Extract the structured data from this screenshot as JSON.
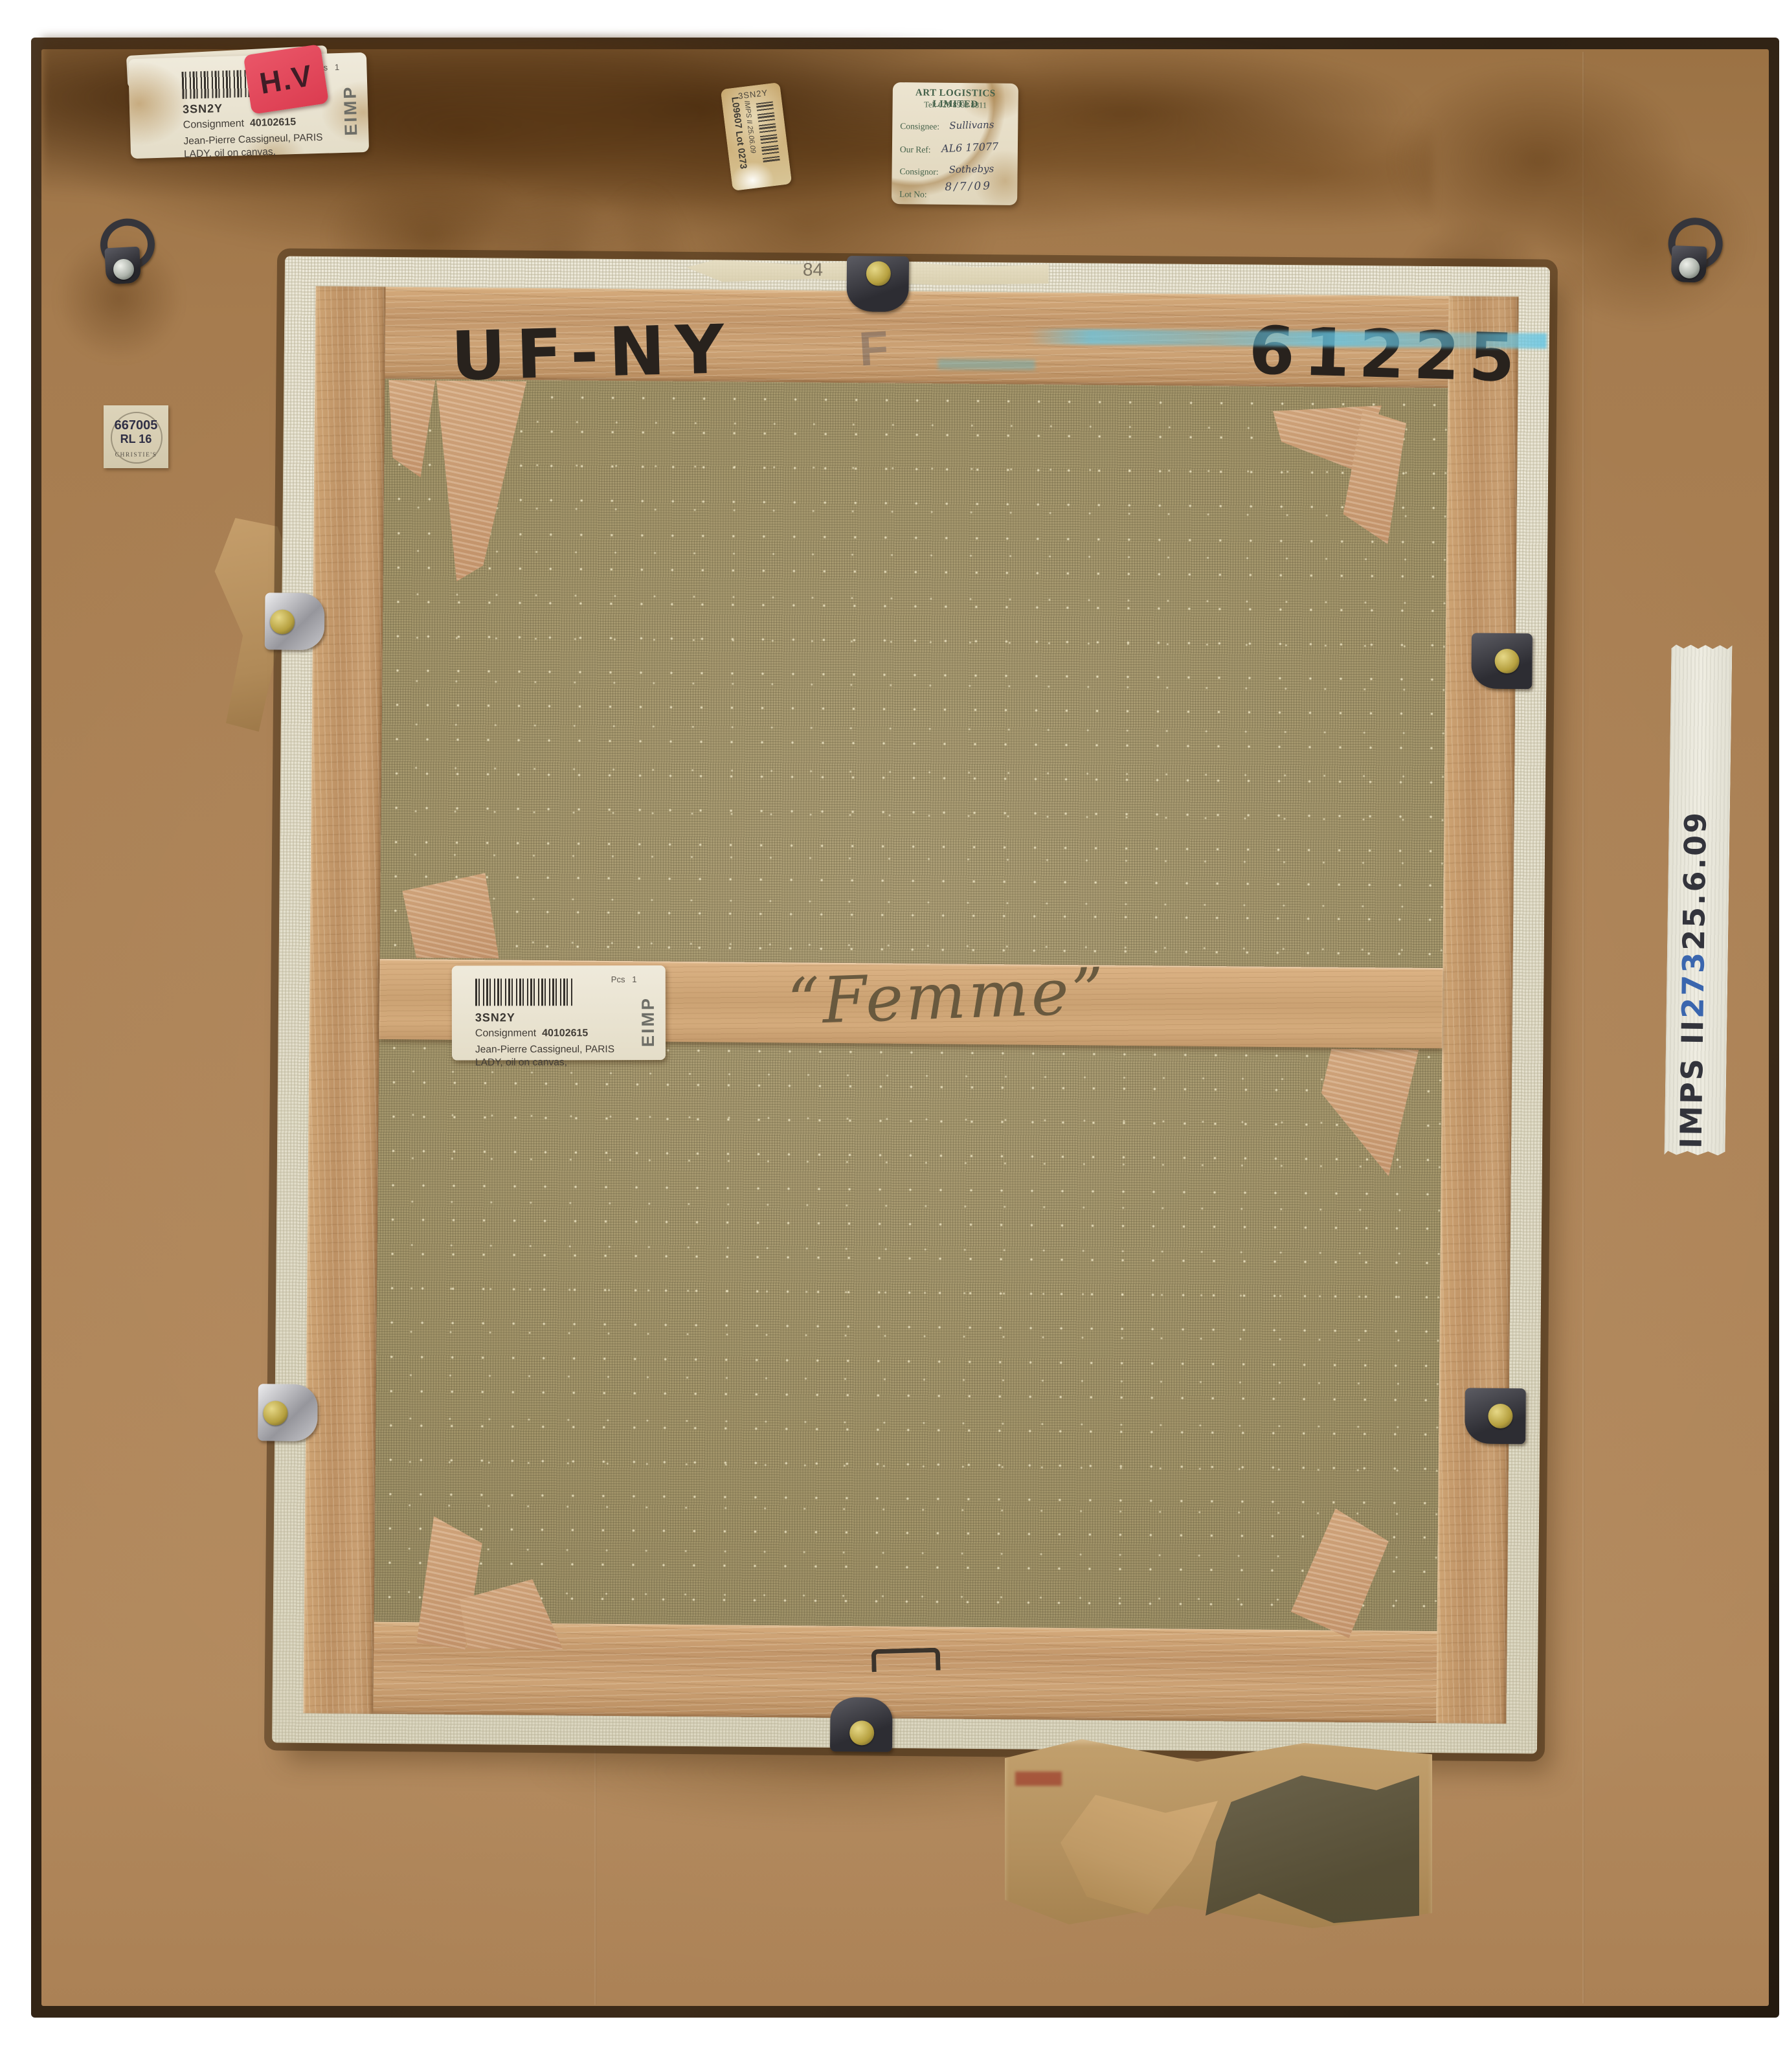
{
  "labels": {
    "consignment": {
      "code": "3SN2Y",
      "consignment_word": "Consignment",
      "number": "40102615",
      "artwork": "Jean-Pierre Cassigneul, PARIS LADY, oil on canvas,",
      "pcs_label": "Pcs",
      "pcs_value": "1",
      "handler_code": "EIMP",
      "hv": "H.V"
    },
    "lot": {
      "code": "3SN2Y",
      "lot_line": "L09607  Lot  0273",
      "sale_line": "IMPS II 25.06.09"
    },
    "art_logistics": {
      "title": "ART LOGISTICS LIMITED",
      "tel": "Tel: 020 8993 8811",
      "consignee_label": "Consignee:",
      "consignee_value": "Sullivans",
      "our_ref_label": "Our Ref:",
      "our_ref_value": "AL6 17077",
      "consignor_label": "Consignor:",
      "consignor_value": "Sothebys",
      "lot_no_label": "Lot No:",
      "date_value": "8/7/09"
    },
    "christies": {
      "number": "667005",
      "location": "RL 16",
      "brand": "CHRISTIE'S"
    },
    "tape": {
      "sale": "IMPS II",
      "lot": "273",
      "date": "25.6.09"
    }
  },
  "inscriptions": {
    "destination": "UF-NY",
    "stock_number": "61225",
    "title": "“Femme”",
    "faint_number": "84",
    "faint_letter": "F"
  },
  "colors": {
    "background": "#ffffff",
    "board": "#a87e53",
    "stain_dark": "#5e3c1c",
    "wood": "#c89d6e",
    "canvas": "#a59a72",
    "canvas_edge": "#e9e5d5",
    "hv_red": "#e2475b",
    "logistics_green": "#44614a",
    "ink_blue_black": "#3d4254",
    "marker_black": "#28221d",
    "marker_blue": "#3a66ae",
    "paint_blue": "#66c6e4",
    "tape_white": "#eae8dd"
  }
}
